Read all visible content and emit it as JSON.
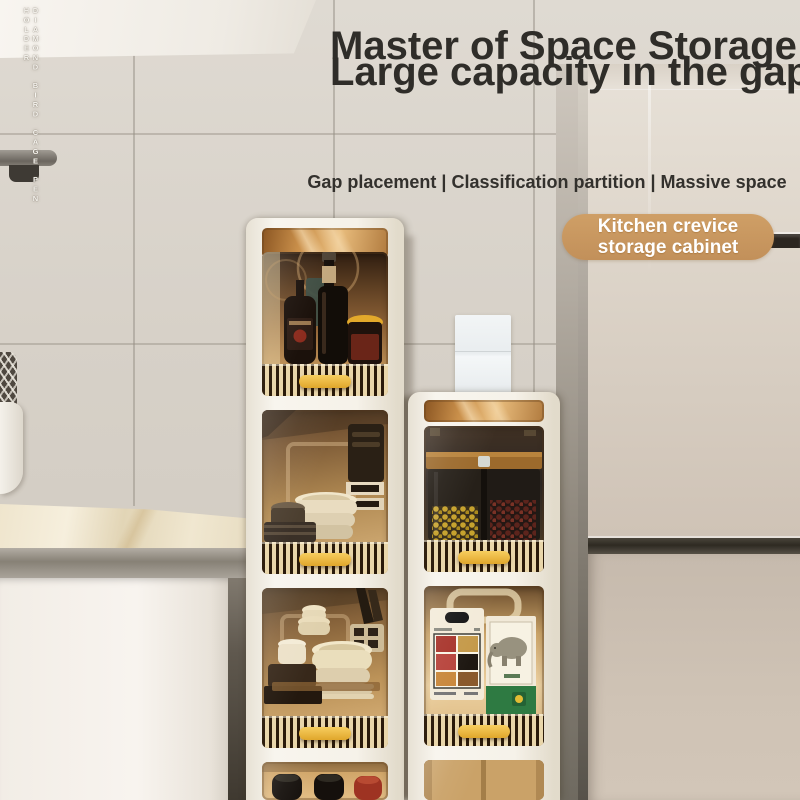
{
  "watermark": {
    "text": "DIAMOND BIRD CAGE PEN HOLDER"
  },
  "headline": {
    "line1": "Master of Space Storage",
    "line2": "Large capacity in the gap"
  },
  "subheadline": {
    "text": "Gap placement | Classification partition | Massive space"
  },
  "badge": {
    "line1": "Kitchen crevice",
    "line2": "storage cabinet"
  },
  "palette": {
    "headline_text": "#2f2d29",
    "badge_bg": "#c8975e",
    "badge_text": "#ffffff",
    "wall_tile": "#d7d1c8",
    "fridge_body": "#ccc0b4",
    "cabinet_frame": "#f6f2e9",
    "cabinet_handle": "#e9b63c",
    "cabinet_interior": "#b08952",
    "countertop_marble": "#ecdfc4"
  }
}
